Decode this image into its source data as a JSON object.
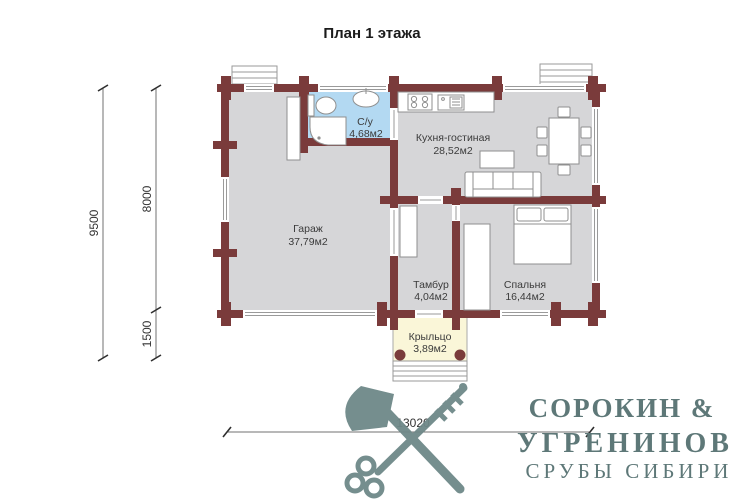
{
  "title": "План 1 этажа",
  "rooms": {
    "bathroom": {
      "name": "С/у",
      "area": "4,68м2"
    },
    "kitchen_living": {
      "name": "Кухня-гостиная",
      "area": "28,52м2"
    },
    "garage": {
      "name": "Гараж",
      "area": "37,79м2"
    },
    "tambour": {
      "name": "Тамбур",
      "area": "4,04м2"
    },
    "bedroom": {
      "name": "Спальня",
      "area": "16,44м2"
    },
    "porch": {
      "name": "Крыльцо",
      "area": "3,89м2"
    }
  },
  "dimensions": {
    "total_height": "9500",
    "main_height": "8000",
    "porch_height": "1500",
    "total_width": "13020"
  },
  "logo": {
    "line1": "СОРОКИН &",
    "line2": "УГРЕНИНОВ",
    "line3": "СРУБЫ СИБИРИ"
  },
  "icons": {
    "watermark": "axe-and-key-icon",
    "bathroom": [
      "toilet-icon",
      "shower-icon",
      "washbasin-icon"
    ],
    "kitchen": [
      "stove-icon",
      "kitchen-sink-icon",
      "dining-table-icon",
      "sofa-icon",
      "coffee-table-icon"
    ],
    "bedroom": [
      "double-bed-icon",
      "wardrobe-icon"
    ]
  },
  "colors": {
    "wall": "#7a3b3b",
    "room": "#d6d6d8",
    "bathroom": "#b3d9f2",
    "porch": "#faf6d8",
    "logo": "#5e7878",
    "watermark": "#6e8888",
    "furniture_stroke": "#8f8f8f"
  }
}
